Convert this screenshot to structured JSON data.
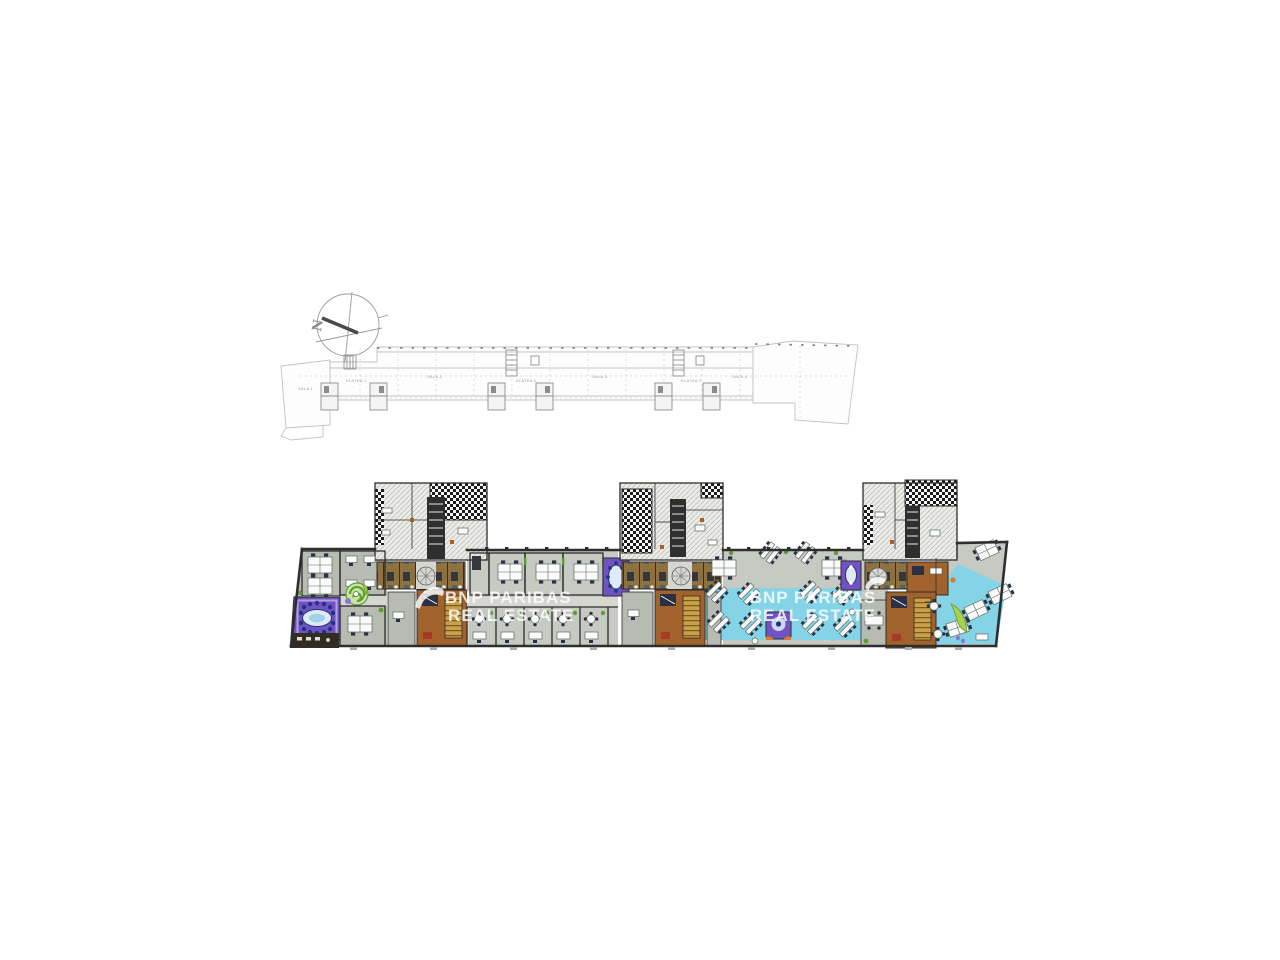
{
  "page": {
    "background": "#ffffff"
  },
  "compass": {
    "label": "N"
  },
  "upper_plan": {
    "labels": [
      {
        "text": "SALA 1"
      },
      {
        "text": "KLATKA 1"
      },
      {
        "text": "SALA 2"
      },
      {
        "text": "KLATKA 2"
      },
      {
        "text": "SALA 3"
      },
      {
        "text": "KLATKA 3"
      },
      {
        "text": "SALA 4"
      }
    ]
  },
  "watermarks": {
    "primary": {
      "line1": "BNP PARIBAS",
      "line2": "REAL ESTATE"
    },
    "secondary": {
      "line1": "BNP PARIBAS",
      "line2": "REAL ESTATE"
    }
  },
  "colors": {
    "bg": "#ffffff",
    "wall": "#2e2e2e",
    "floor": "#c7c9c3",
    "room": "#b7bbb2",
    "corridor": "#d6d7d1",
    "towerRoom": "#ebebe7",
    "cyan": "#84d3e6",
    "purple": "#7152c3",
    "purpleLight": "#b3a2e0",
    "blueChair": "#21357e",
    "tableTop": "#dfeaf6",
    "brown": "#a2622b",
    "cells": "#8d7140",
    "stairFill": "#c99f4a",
    "tread": "#6b4a16",
    "darkBand": "#332c20",
    "green": "#5f9e33",
    "lime": "#a5d44b",
    "desk": "#fafafa",
    "deskLine": "#5a6a62",
    "chair": "#2b3044",
    "orange": "#d97a2c",
    "red": "#a83828",
    "faint": "#c2c2c2",
    "mid": "#8f8f8f",
    "wmColor": "#ffffff"
  }
}
